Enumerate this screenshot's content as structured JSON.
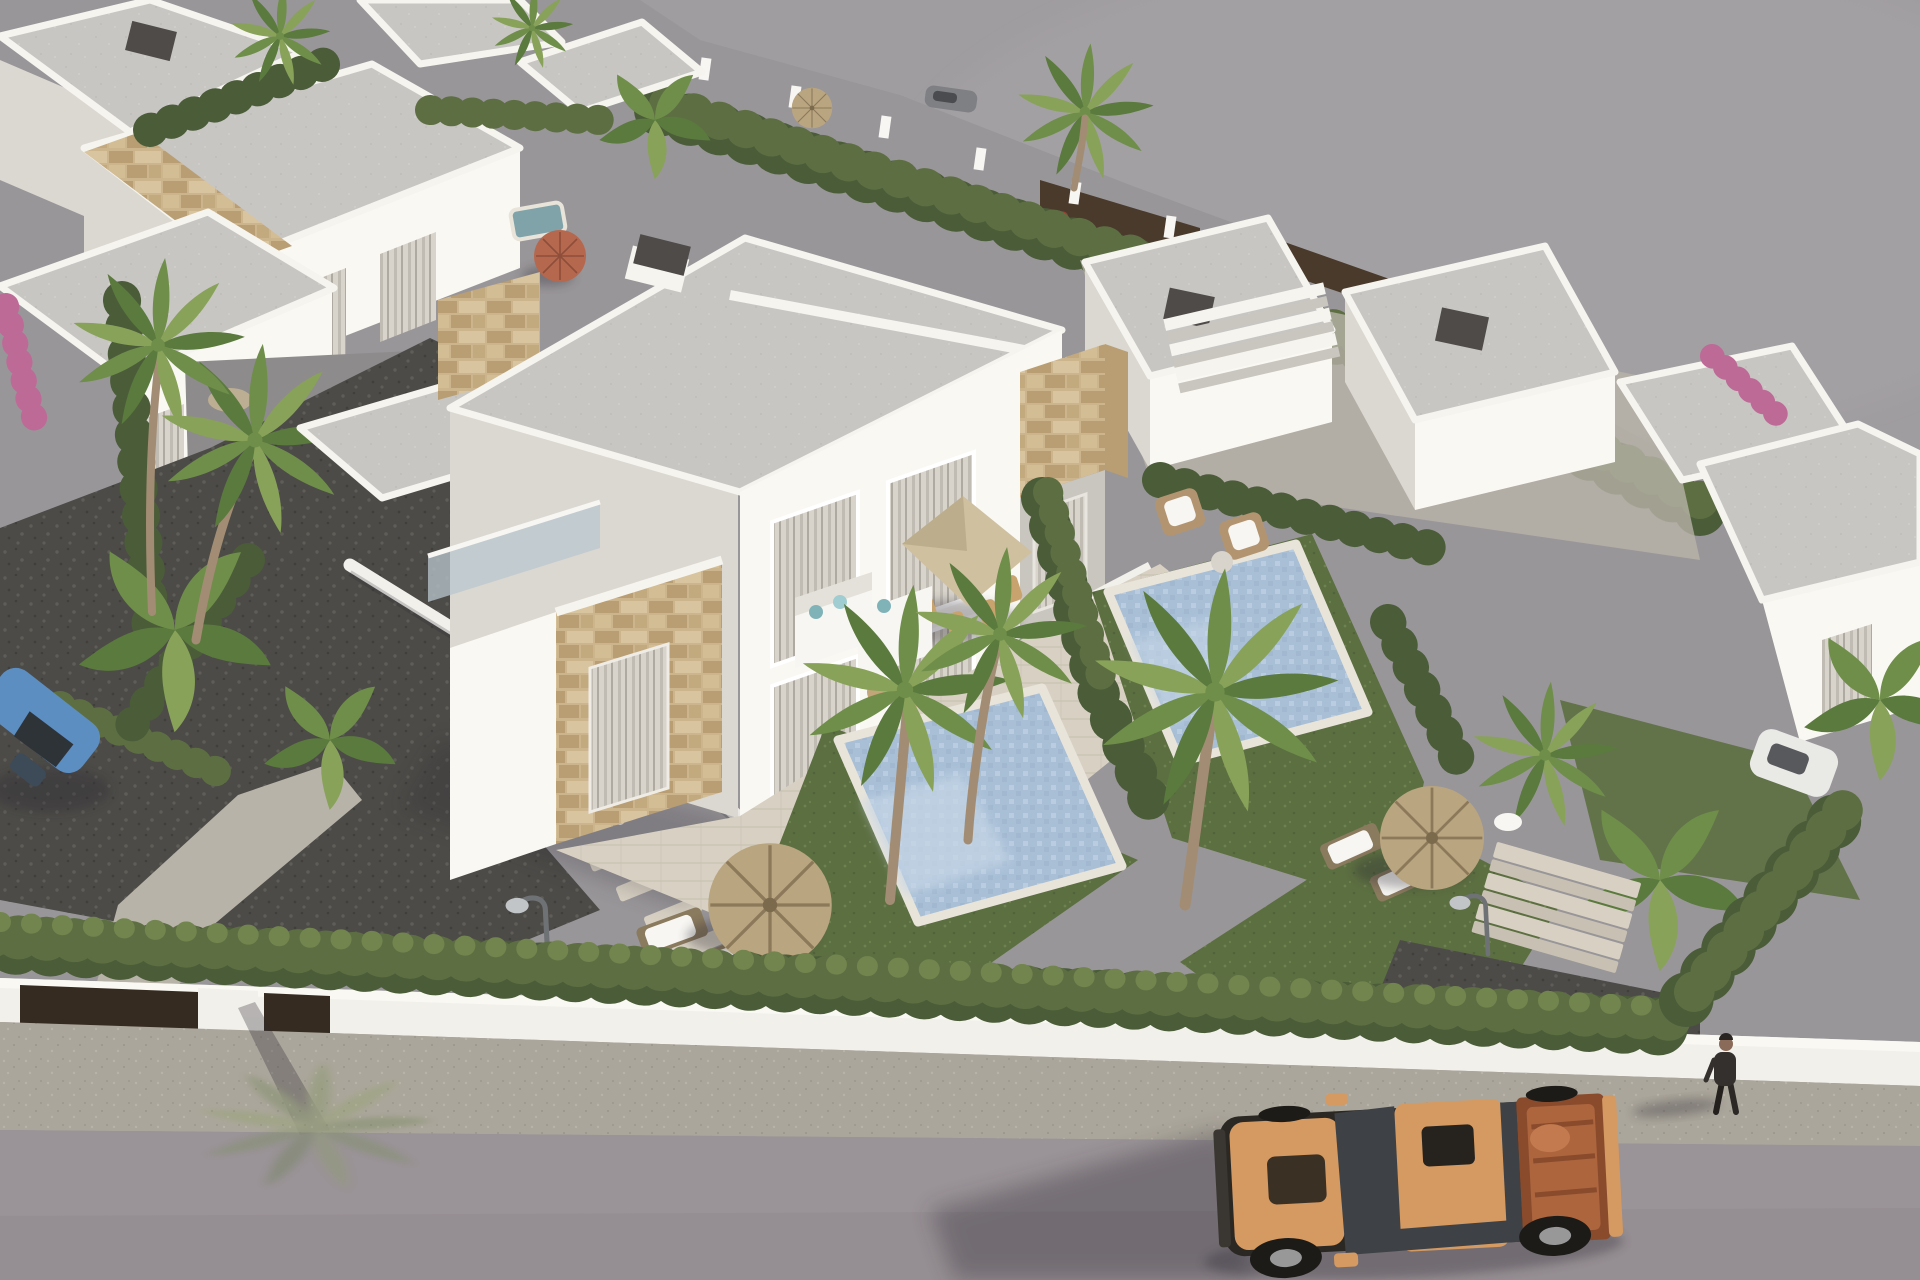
{
  "meta": {
    "title": "Aerial 3D render of a modern white villa development with private pools",
    "image_type": "architectural visualization",
    "view": "aerial three-quarter (bird's eye) view",
    "width": 1920,
    "height": 1280
  },
  "scene": {
    "setting": "new-build Mediterranean residential complex of flat-roofed white villas with natural stone accents",
    "focal_point": "two-storey semi-detached villa with covered terrace, outdoor lounge, dining parasol and two private pools",
    "foreground": "asphalt street and gravel sidewalk along a white perimeter wall topped by a cypress hedge",
    "background": "flat bare grey terrain beyond the rear boundary hedge and fence",
    "landscaping": [
      "fan palms",
      "banana plants",
      "cypress hedges",
      "lawns",
      "thatched parasols",
      "terracotta parasol",
      "bougainvillea",
      "stone pathway",
      "stepping stones"
    ],
    "vehicles": [
      {
        "name": "orange pickup truck",
        "location": "street, bottom right, facing left"
      },
      {
        "name": "blue convertible",
        "location": "driveway at left edge, partly hidden by banana leaves"
      },
      {
        "name": "white car",
        "location": "behind hedge at right edge"
      },
      {
        "name": "grey car",
        "location": "behind rear hedge, top centre"
      },
      {
        "name": "red ride-on toy",
        "location": "rear garden, top right"
      }
    ],
    "people": [
      {
        "name": "pedestrian",
        "location": "sidewalk at bottom right, walking left, casting long shadow"
      }
    ],
    "furniture": [
      "white corner sofa with teal cushions",
      "dining table with chairs under square beige parasol",
      "two wicker armchairs with white cushions",
      "wooden sun loungers",
      "garden post lamps"
    ],
    "structures": [
      "central duplex villa",
      "left single-storey wing with stone cladding and glass balustrade roof terrace",
      "neighbouring villas top-left",
      "neighbouring villas centre-right with external staircase and dark chimneys",
      "far-right villa",
      "white perimeter wall with dark entrance gate",
      "garden steps at right"
    ]
  },
  "palette": {
    "terrain": "#a09da0",
    "terrain2": "#999699",
    "road": "#9a9397",
    "sidewalk": "#aba69b",
    "sidewalk2": "#b8b3a8",
    "wallwhite": "#f2f0eb",
    "walllit": "#faf8f3",
    "wallshade": "#dbd7d1",
    "wallshade2": "#c9c5bf",
    "roof": "#c8c6c3",
    "rooflight": "#d7d5d2",
    "parapet": "#f6f4ef",
    "stone1": "#ccb48d",
    "stone2": "#b89e72",
    "glass": "#595e63",
    "glassdark": "#3e4246",
    "curtain": "#d8d4cc",
    "curtain2": "#c0bcb4",
    "hedge1": "#4b5c39",
    "hedge2": "#5d6f42",
    "hedge3": "#72854e",
    "lawn1": "#5c6f41",
    "lawn2": "#6e8150",
    "gravel": "#4c4b47",
    "graveldot": "#5e5d58",
    "graveldot2": "#403f3b",
    "deck": "#d8d1c3",
    "deck2": "#c8c1b3",
    "pool": "#a8bfd6",
    "pool2": "#c6d6e6",
    "poolline": "#8aa5bf",
    "curb": "#e8e4da",
    "palm1": "#5b7a3e",
    "palm2": "#6f8e4a",
    "palm3": "#88a259",
    "trunk": "#a28d74",
    "thatch": "#b9a57f",
    "thatchline": "#8c795a",
    "terracotta": "#b5684e",
    "parasol": "#cfc0a0",
    "truck": "#d59a62",
    "truckdark": "#2b2824",
    "truckbed": "#ad653e",
    "truckbed2": "#8a4b2d",
    "rim": "#989898",
    "carblue": "#5c8ec2",
    "carwhite": "#e9e9e6",
    "white": "#f7f6f2",
    "darkgray": "#4e4b49",
    "brownfence": "#4a3a2c",
    "browndark": "#362b21",
    "pink": "#bd6a97",
    "skin": "#8a6a58",
    "lamphead": "#c2c5c7",
    "pole": "#6f7275",
    "shadow": "#2b2830",
    "teal": "#7fb3b8",
    "minipool": "#7fa3a8",
    "rail": "#b9c7cd"
  }
}
